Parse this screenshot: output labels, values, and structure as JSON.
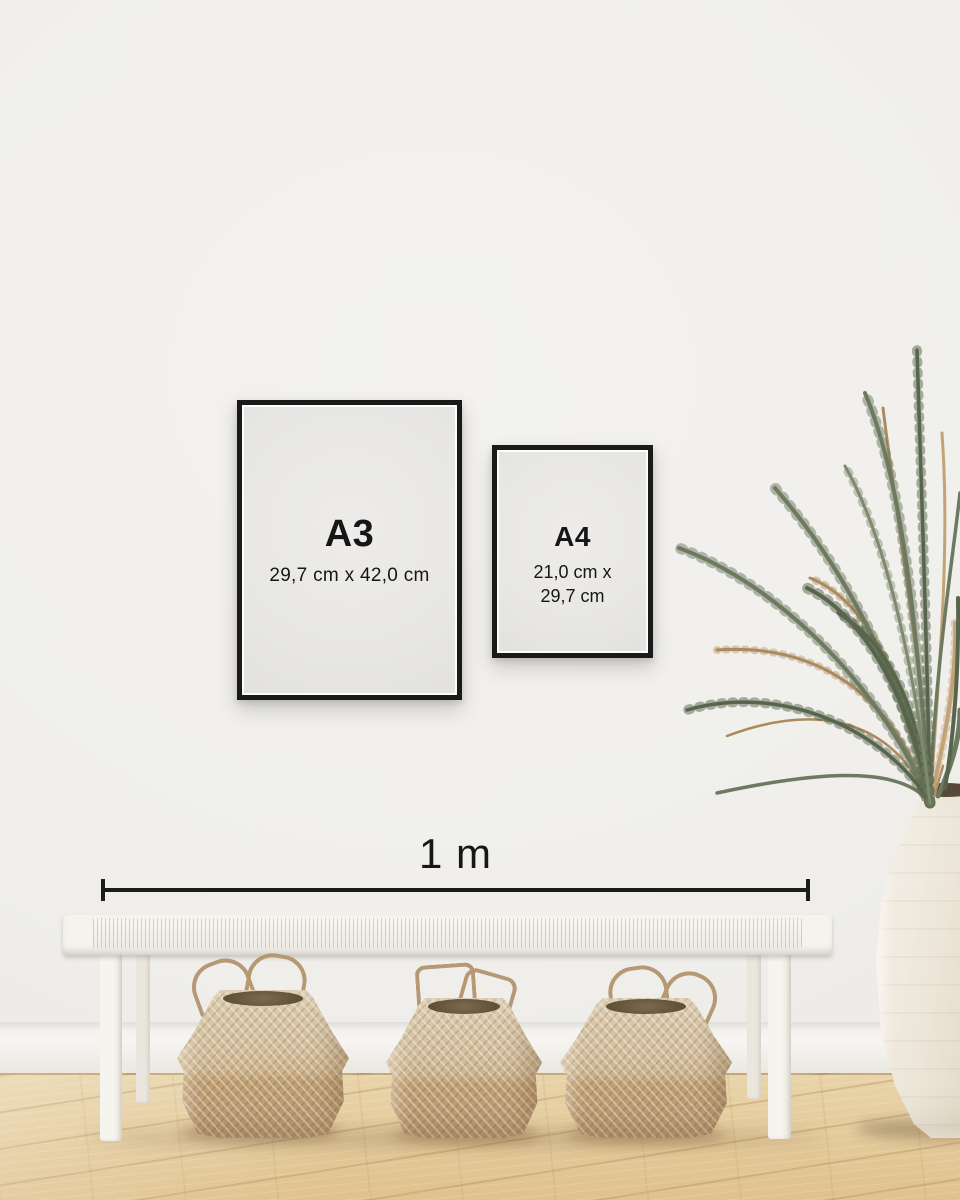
{
  "frames": [
    {
      "label": "A3",
      "size": "29,7 cm x 42,0 cm"
    },
    {
      "label": "A4",
      "size_line1": "21,0 cm x",
      "size_line2": "29,7 cm"
    }
  ],
  "scale_bar": {
    "label": "1 m"
  },
  "colors": {
    "wall": "#f0efec",
    "baseboard": "#f6f5f1",
    "frame": "#1a1a1a",
    "paper": "#e8e7e4",
    "text": "#161616",
    "floor-light": "#e8d4a9",
    "floor-dark": "#dfc18c",
    "bench": "#f5f3ee",
    "basket-light": "#d3bf9e",
    "basket-dark": "#bf9f73",
    "basket-rim": "#5f5038",
    "plant-green": "#6d7a60",
    "plant-green-dark": "#57654c",
    "plant-brown": "#ab8a5e",
    "vase": "#ece5d8"
  }
}
